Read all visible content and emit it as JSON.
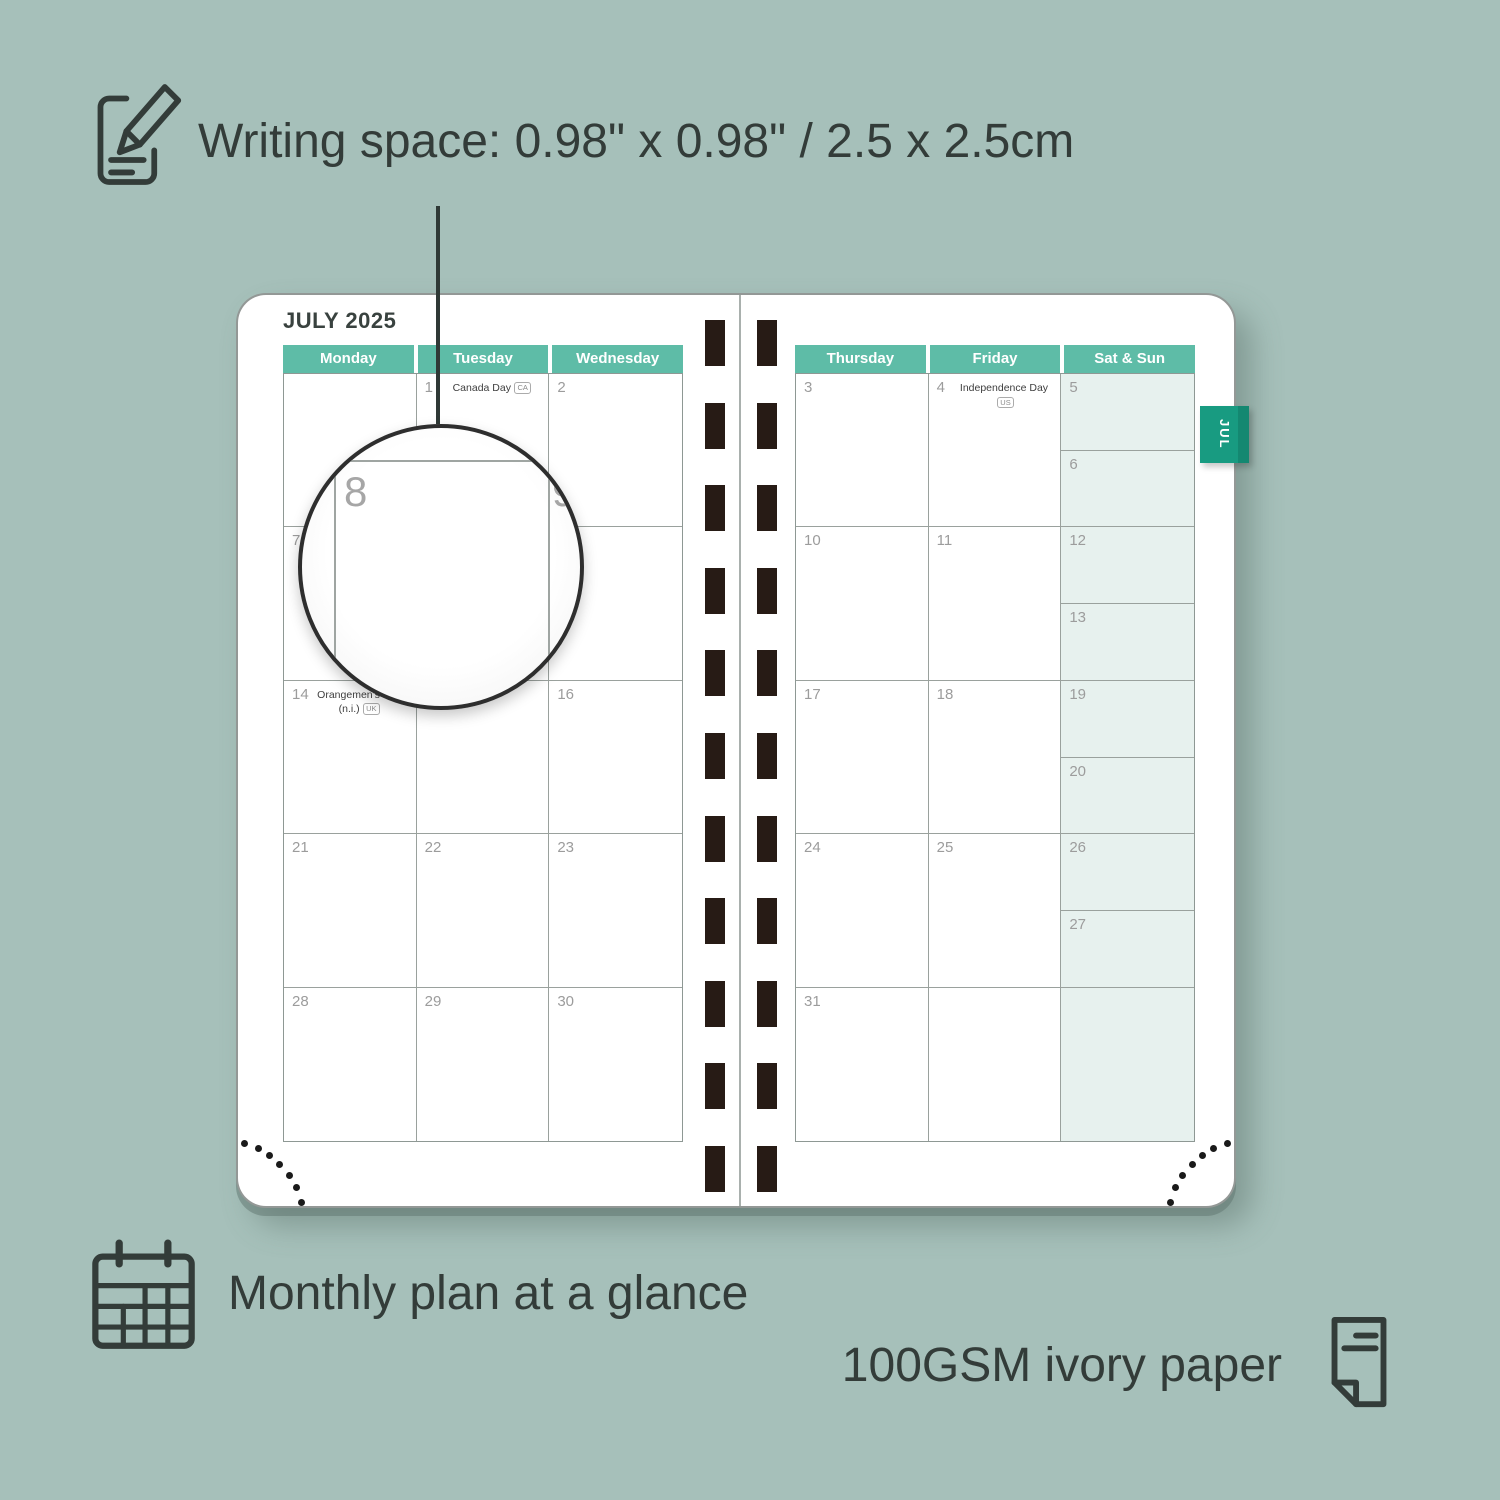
{
  "annotations": {
    "writing_space": "Writing space: 0.98\" x 0.98\" / 2.5 x 2.5cm",
    "monthly_plan": "Monthly plan at a glance",
    "paper": "100GSM ivory paper"
  },
  "planner": {
    "month_title": "JULY 2025",
    "tab_label": "JUL",
    "magnifier": {
      "day": "8",
      "next_day": "9"
    },
    "left_page": {
      "headers": [
        "Monday",
        "Tuesday",
        "Wednesday"
      ],
      "rows": [
        [
          {
            "day": ""
          },
          {
            "day": "1",
            "holiday": "Canada Day",
            "badge": "CA"
          },
          {
            "day": "2"
          }
        ],
        [
          {
            "day": "7"
          },
          {
            "day": "8"
          },
          {
            "day": "9"
          }
        ],
        [
          {
            "day": "14",
            "holiday": "Orangemen's Day (n.i.)",
            "badge": "UK"
          },
          {
            "day": "15"
          },
          {
            "day": "16"
          }
        ],
        [
          {
            "day": "21"
          },
          {
            "day": "22"
          },
          {
            "day": "23"
          }
        ],
        [
          {
            "day": "28"
          },
          {
            "day": "29"
          },
          {
            "day": "30"
          }
        ]
      ]
    },
    "right_page": {
      "headers": [
        "Thursday",
        "Friday",
        "Sat & Sun"
      ],
      "rows": [
        {
          "days": [
            {
              "day": "3"
            },
            {
              "day": "4",
              "holiday": "Independence Day",
              "badge": "US"
            }
          ],
          "weekend": [
            {
              "day": "5"
            },
            {
              "day": "6"
            }
          ]
        },
        {
          "days": [
            {
              "day": "10"
            },
            {
              "day": "11"
            }
          ],
          "weekend": [
            {
              "day": "12"
            },
            {
              "day": "13"
            }
          ]
        },
        {
          "days": [
            {
              "day": "17"
            },
            {
              "day": "18"
            }
          ],
          "weekend": [
            {
              "day": "19"
            },
            {
              "day": "20"
            }
          ]
        },
        {
          "days": [
            {
              "day": "24"
            },
            {
              "day": "25"
            }
          ],
          "weekend": [
            {
              "day": "26"
            },
            {
              "day": "27"
            }
          ]
        },
        {
          "days": [
            {
              "day": "31"
            },
            {
              "day": ""
            }
          ],
          "weekend": [
            {
              "day": ""
            }
          ]
        }
      ]
    }
  },
  "colors": {
    "background": "#A6C0BA",
    "ink": "#333C39",
    "header_teal": "#5EBCA7",
    "tab_teal": "#189B81",
    "weekend_bg": "#E7F1EE",
    "grid_line": "#9AA19D",
    "day_number": "#9C9C9C",
    "binding_hole": "#271B15"
  }
}
